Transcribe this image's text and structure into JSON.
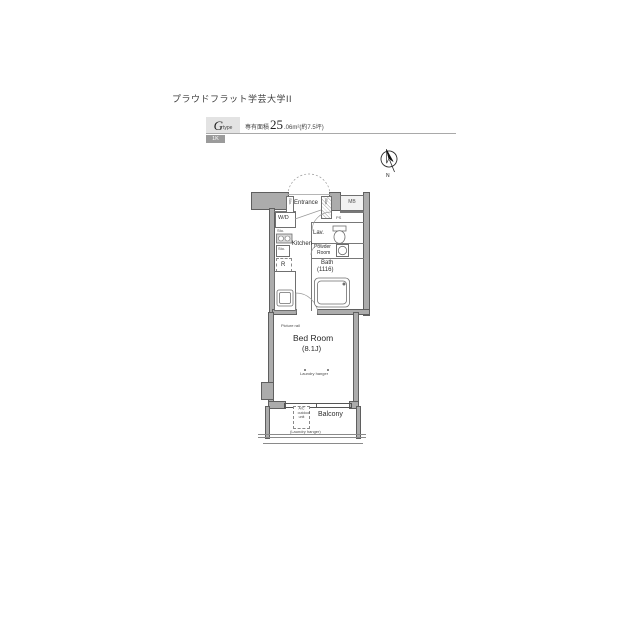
{
  "page": {
    "title": "プラウドフラット学芸大学II"
  },
  "header": {
    "type_letter": "G",
    "type_word": "type",
    "badge": "1K",
    "area_label": "専有面積",
    "area_big": "25",
    "area_small": ".06m²(約7.5坪)"
  },
  "compass": {
    "north": "N"
  },
  "plan": {
    "entrance": "Entrance",
    "mb": "MB",
    "ps": "PS",
    "sto_left": "Sto.",
    "sto_right": "Sto.",
    "wd": "W/D",
    "wd_sub": "Sto.",
    "sto_small": "Sto.",
    "fridge": "R",
    "kitchen": "Kitchen",
    "lav": "Lav.",
    "powder_line1": "Powder",
    "powder_line2": "Room",
    "bath_line1": "Bath",
    "bath_line2": "(1116)",
    "picture_rail": "Picture rail",
    "bedroom_line1": "Bed Room",
    "bedroom_line2": "(8.1J)",
    "laundry": "Laundry hanger",
    "balcony": "Balcony",
    "ac_line1": "A/C",
    "ac_line2": "outdoor",
    "ac_line3": "unit",
    "ac_note": "(Laundry hanger)"
  }
}
